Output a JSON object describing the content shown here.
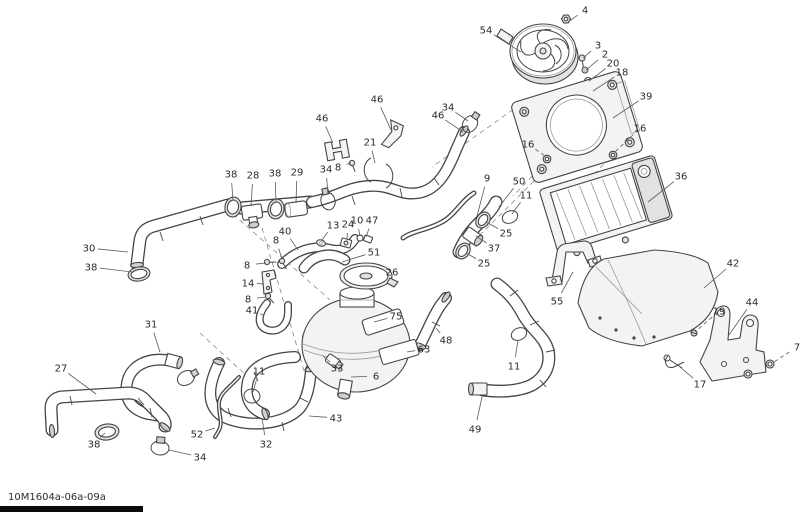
{
  "diagram_code": "10M1604a-06a-09a",
  "colors": {
    "line": "#454545",
    "label": "#2b2b2b",
    "background": "#ffffff"
  },
  "callouts": [
    {
      "label": "4",
      "x": 585,
      "y": 10,
      "tx": 568,
      "ty": 22
    },
    {
      "label": "54",
      "x": 486,
      "y": 30,
      "tx": 521,
      "ty": 52
    },
    {
      "label": "3",
      "x": 598,
      "y": 45,
      "tx": 583,
      "ty": 58
    },
    {
      "label": "2",
      "x": 605,
      "y": 54,
      "tx": 586,
      "ty": 70
    },
    {
      "label": "20",
      "x": 613,
      "y": 63,
      "tx": 589,
      "ty": 81
    },
    {
      "label": "18",
      "x": 622,
      "y": 72,
      "tx": 593,
      "ty": 91
    },
    {
      "label": "39",
      "x": 646,
      "y": 96,
      "tx": 613,
      "ty": 118
    },
    {
      "label": "16",
      "x": 640,
      "y": 128,
      "tx": 615,
      "ty": 152,
      "dash": true
    },
    {
      "label": "16",
      "x": 528,
      "y": 144,
      "tx": 545,
      "ty": 156,
      "dash": true
    },
    {
      "label": "36",
      "x": 681,
      "y": 176,
      "tx": 648,
      "ty": 202
    },
    {
      "label": "9",
      "x": 487,
      "y": 178,
      "tx": 477,
      "ty": 216
    },
    {
      "label": "50",
      "x": 519,
      "y": 181,
      "tx": 499,
      "ty": 207
    },
    {
      "label": "11",
      "x": 526,
      "y": 195,
      "tx": 512,
      "ty": 214
    },
    {
      "label": "25",
      "x": 506,
      "y": 233,
      "tx": 486,
      "ty": 222
    },
    {
      "label": "37",
      "x": 494,
      "y": 248,
      "tx": 476,
      "ty": 236
    },
    {
      "label": "25",
      "x": 484,
      "y": 263,
      "tx": 466,
      "ty": 253
    },
    {
      "label": "34",
      "x": 448,
      "y": 107,
      "tx": 468,
      "ty": 121
    },
    {
      "label": "46",
      "x": 438,
      "y": 115,
      "tx": 463,
      "ty": 132
    },
    {
      "label": "46",
      "x": 377,
      "y": 99,
      "tx": 391,
      "ty": 130
    },
    {
      "label": "21",
      "x": 370,
      "y": 142,
      "tx": 375,
      "ty": 163
    },
    {
      "label": "46",
      "x": 322,
      "y": 118,
      "tx": 333,
      "ty": 143
    },
    {
      "label": "34",
      "x": 326,
      "y": 169,
      "tx": 328,
      "ty": 195
    },
    {
      "label": "8",
      "x": 338,
      "y": 167,
      "tx": 351,
      "ty": 163
    },
    {
      "label": "38",
      "x": 231,
      "y": 174,
      "tx": 233,
      "ty": 200
    },
    {
      "label": "28",
      "x": 253,
      "y": 175,
      "tx": 251,
      "ty": 206
    },
    {
      "label": "38",
      "x": 275,
      "y": 173,
      "tx": 276,
      "ty": 202
    },
    {
      "label": "29",
      "x": 297,
      "y": 172,
      "tx": 296,
      "ty": 203
    },
    {
      "label": "30",
      "x": 89,
      "y": 248,
      "tx": 128,
      "ty": 252
    },
    {
      "label": "38",
      "x": 91,
      "y": 267,
      "tx": 132,
      "ty": 272
    },
    {
      "label": "13",
      "x": 333,
      "y": 225,
      "tx": 322,
      "ty": 240
    },
    {
      "label": "24",
      "x": 348,
      "y": 224,
      "tx": 347,
      "ty": 239
    },
    {
      "label": "10",
      "x": 357,
      "y": 220,
      "tx": 360,
      "ty": 236
    },
    {
      "label": "47",
      "x": 372,
      "y": 220,
      "tx": 366,
      "ty": 237
    },
    {
      "label": "40",
      "x": 285,
      "y": 231,
      "tx": 298,
      "ty": 250
    },
    {
      "label": "8",
      "x": 276,
      "y": 240,
      "tx": 282,
      "ty": 259
    },
    {
      "label": "8",
      "x": 247,
      "y": 265,
      "tx": 266,
      "ty": 263
    },
    {
      "label": "14",
      "x": 248,
      "y": 283,
      "tx": 264,
      "ty": 284
    },
    {
      "label": "8",
      "x": 248,
      "y": 299,
      "tx": 266,
      "ty": 297
    },
    {
      "label": "41",
      "x": 252,
      "y": 310,
      "tx": 263,
      "ty": 315
    },
    {
      "label": "51",
      "x": 374,
      "y": 252,
      "tx": 342,
      "ty": 262
    },
    {
      "label": "26",
      "x": 392,
      "y": 272,
      "tx": 384,
      "ty": 276
    },
    {
      "label": "75",
      "x": 396,
      "y": 316,
      "tx": 374,
      "ty": 322
    },
    {
      "label": "63",
      "x": 424,
      "y": 349,
      "tx": 407,
      "ty": 352
    },
    {
      "label": "48",
      "x": 446,
      "y": 340,
      "tx": 436,
      "ty": 328
    },
    {
      "label": "33",
      "x": 337,
      "y": 368,
      "tx": 323,
      "ty": 356
    },
    {
      "label": "6",
      "x": 376,
      "y": 376,
      "tx": 351,
      "ty": 377
    },
    {
      "label": "55",
      "x": 557,
      "y": 301,
      "tx": 573,
      "ty": 272
    },
    {
      "label": "42",
      "x": 733,
      "y": 263,
      "tx": 704,
      "ty": 288
    },
    {
      "label": "19",
      "x": 719,
      "y": 311,
      "tx": 695,
      "ty": 332,
      "dash": true
    },
    {
      "label": "44",
      "x": 752,
      "y": 302,
      "tx": 729,
      "ty": 335
    },
    {
      "label": "17",
      "x": 700,
      "y": 384,
      "tx": 680,
      "ty": 367
    },
    {
      "label": "7",
      "x": 797,
      "y": 347,
      "tx": 774,
      "ty": 362,
      "dash": true
    },
    {
      "label": "31",
      "x": 151,
      "y": 324,
      "tx": 160,
      "ty": 352
    },
    {
      "label": "27",
      "x": 61,
      "y": 368,
      "tx": 96,
      "ty": 394
    },
    {
      "label": "38",
      "x": 94,
      "y": 444,
      "tx": 105,
      "ty": 433
    },
    {
      "label": "34",
      "x": 200,
      "y": 457,
      "tx": 169,
      "ty": 450
    },
    {
      "label": "52",
      "x": 197,
      "y": 434,
      "tx": 215,
      "ty": 428
    },
    {
      "label": "32",
      "x": 266,
      "y": 444,
      "tx": 262,
      "ty": 418
    },
    {
      "label": "11",
      "x": 259,
      "y": 371,
      "tx": 253,
      "ty": 392
    },
    {
      "label": "43",
      "x": 336,
      "y": 418,
      "tx": 309,
      "ty": 416
    },
    {
      "label": "49",
      "x": 475,
      "y": 429,
      "tx": 482,
      "ty": 397
    },
    {
      "label": "11",
      "x": 514,
      "y": 366,
      "tx": 518,
      "ty": 340
    }
  ]
}
